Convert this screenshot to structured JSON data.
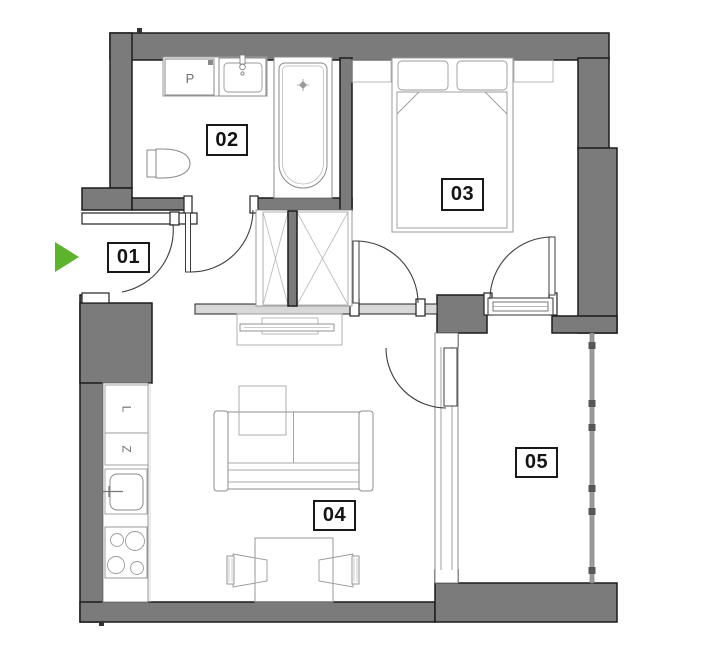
{
  "plan": {
    "rooms": [
      {
        "id": "room-01",
        "label": "01"
      },
      {
        "id": "room-02",
        "label": "02"
      },
      {
        "id": "room-03",
        "label": "03"
      },
      {
        "id": "room-04",
        "label": "04"
      },
      {
        "id": "room-05",
        "label": "05"
      }
    ],
    "appliance_labels": {
      "washing_machine": "P",
      "kitchen_unit_l": "L",
      "kitchen_unit_z": "Z"
    },
    "colors": {
      "wall": "#7b7b7b",
      "wall_outline": "#1c1c1c",
      "accent_green": "#5eb32c",
      "light_fill": "#d8d8d8"
    }
  }
}
